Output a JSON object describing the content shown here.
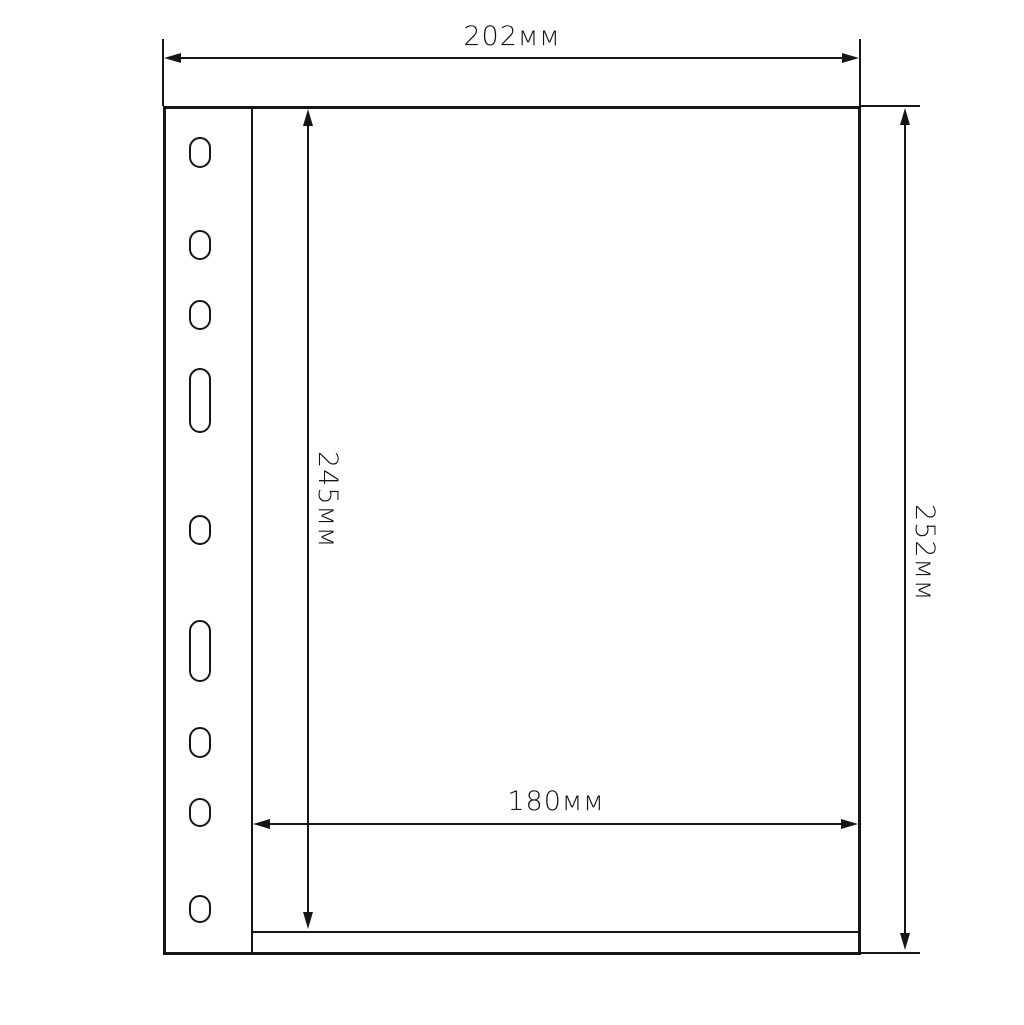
{
  "drawing": {
    "description": "Technical dimension drawing of a binder pocket sheet with punch holes",
    "unit": "мм",
    "line_color": "#161616",
    "background_color": "#ffffff",
    "dimensions": {
      "outer_width": {
        "value": 202,
        "unit": "мм",
        "label": "202мм",
        "position": "top"
      },
      "outer_height": {
        "value": 252,
        "unit": "мм",
        "label": "252мм",
        "position": "right"
      },
      "pocket_height": {
        "value": 245,
        "unit": "мм",
        "label": "245мм",
        "position": "inner-left"
      },
      "pocket_width": {
        "value": 180,
        "unit": "мм",
        "label": "180мм",
        "position": "inner-bottom"
      }
    },
    "punch_holes": {
      "count": 9,
      "holes": [
        {
          "top": 137,
          "height": 31,
          "size": "small"
        },
        {
          "top": 230,
          "height": 30,
          "size": "small"
        },
        {
          "top": 300,
          "height": 30,
          "size": "small"
        },
        {
          "top": 368,
          "height": 65,
          "size": "large"
        },
        {
          "top": 515,
          "height": 30,
          "size": "small"
        },
        {
          "top": 620,
          "height": 62,
          "size": "large"
        },
        {
          "top": 727,
          "height": 31,
          "size": "small"
        },
        {
          "top": 798,
          "height": 29,
          "size": "small"
        },
        {
          "top": 895,
          "height": 28,
          "size": "small"
        }
      ]
    }
  }
}
